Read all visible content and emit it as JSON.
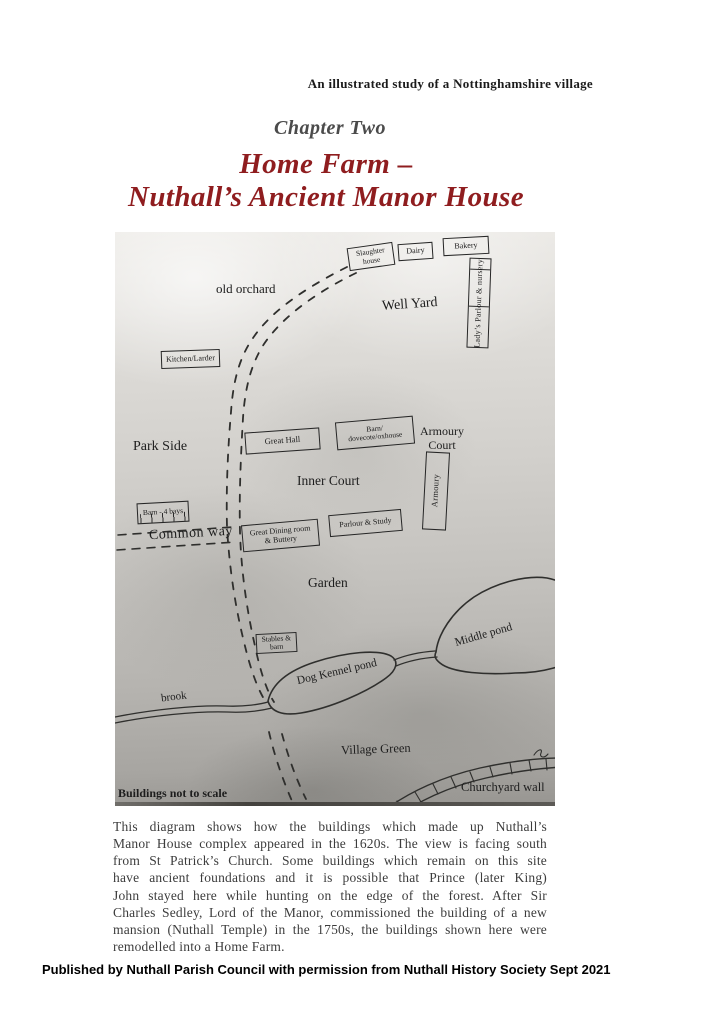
{
  "page": {
    "header": "An illustrated study of a Nottinghamshire village",
    "chapter": "Chapter Two",
    "title_line1": "Home Farm –",
    "title_line2": "Nuthall’s Ancient Manor House",
    "paragraph_lines": [
      "This diagram shows how the buildings which made up Nuthall’s",
      "Manor House complex appeared in the 1620s. The view is facing south",
      "from St Patrick’s Church. Some buildings which remain on this site",
      "have ancient foundations and it is possible that Prince (later King)",
      "John stayed here while hunting on the edge of the forest. After Sir",
      "Charles Sedley, Lord of the Manor, commissioned the building of a new",
      "mansion (Nuthall Temple) in the 1750s, the buildings shown here were",
      "remodelled into a Home Farm."
    ],
    "footer": "Published by Nuthall Parish Council with permission from Nuthall History Society Sept 2021"
  },
  "colors": {
    "title_red": "#8f1d1f",
    "chapter_gray": "#4b4b4b",
    "diagram_ink": "#2f2f2d"
  },
  "diagram": {
    "boxes": [
      {
        "id": "slaughter-house",
        "line1": "Slaughter",
        "line2": "house"
      },
      {
        "id": "dairy",
        "line1": "Dairy"
      },
      {
        "id": "bakery",
        "line1": "Bakery"
      },
      {
        "id": "ladys-parlour-nursery",
        "line1": "Lady’s Parlour & nursery"
      },
      {
        "id": "kitchen-larder",
        "line1": "Kitchen/Larder"
      },
      {
        "id": "great-hall",
        "line1": "Great Hall"
      },
      {
        "id": "barn-dovecote-oxhouse",
        "line1": "Barn/",
        "line2": "dovecote/oxhouse"
      },
      {
        "id": "armoury",
        "line1": "Armoury"
      },
      {
        "id": "barn-4-bays",
        "line1": "Barn - 4 bays"
      },
      {
        "id": "great-dining-room-buttery",
        "line1": "Great Dining room",
        "line2": "& Buttery"
      },
      {
        "id": "parlour-study",
        "line1": "Parlour & Study"
      },
      {
        "id": "stables-barn",
        "line1": "Stables &",
        "line2": "barn"
      }
    ],
    "areas": [
      {
        "id": "old-orchard",
        "text": "old orchard"
      },
      {
        "id": "well-yard",
        "text": "Well Yard"
      },
      {
        "id": "park-side",
        "text": "Park Side"
      },
      {
        "id": "armoury-court",
        "text": "Armoury",
        "text2": "Court"
      },
      {
        "id": "inner-court",
        "text": "Inner Court"
      },
      {
        "id": "common-way",
        "text": "Common way"
      },
      {
        "id": "garden",
        "text": "Garden"
      },
      {
        "id": "brook",
        "text": "brook"
      },
      {
        "id": "dog-kennel-pond",
        "text": "Dog Kennel pond"
      },
      {
        "id": "middle-pond",
        "text": "Middle pond"
      },
      {
        "id": "village-green",
        "text": "Village Green"
      },
      {
        "id": "buildings-note",
        "text": "Buildings not to scale"
      },
      {
        "id": "churchyard-wall",
        "text": "Churchyard wall"
      }
    ]
  }
}
